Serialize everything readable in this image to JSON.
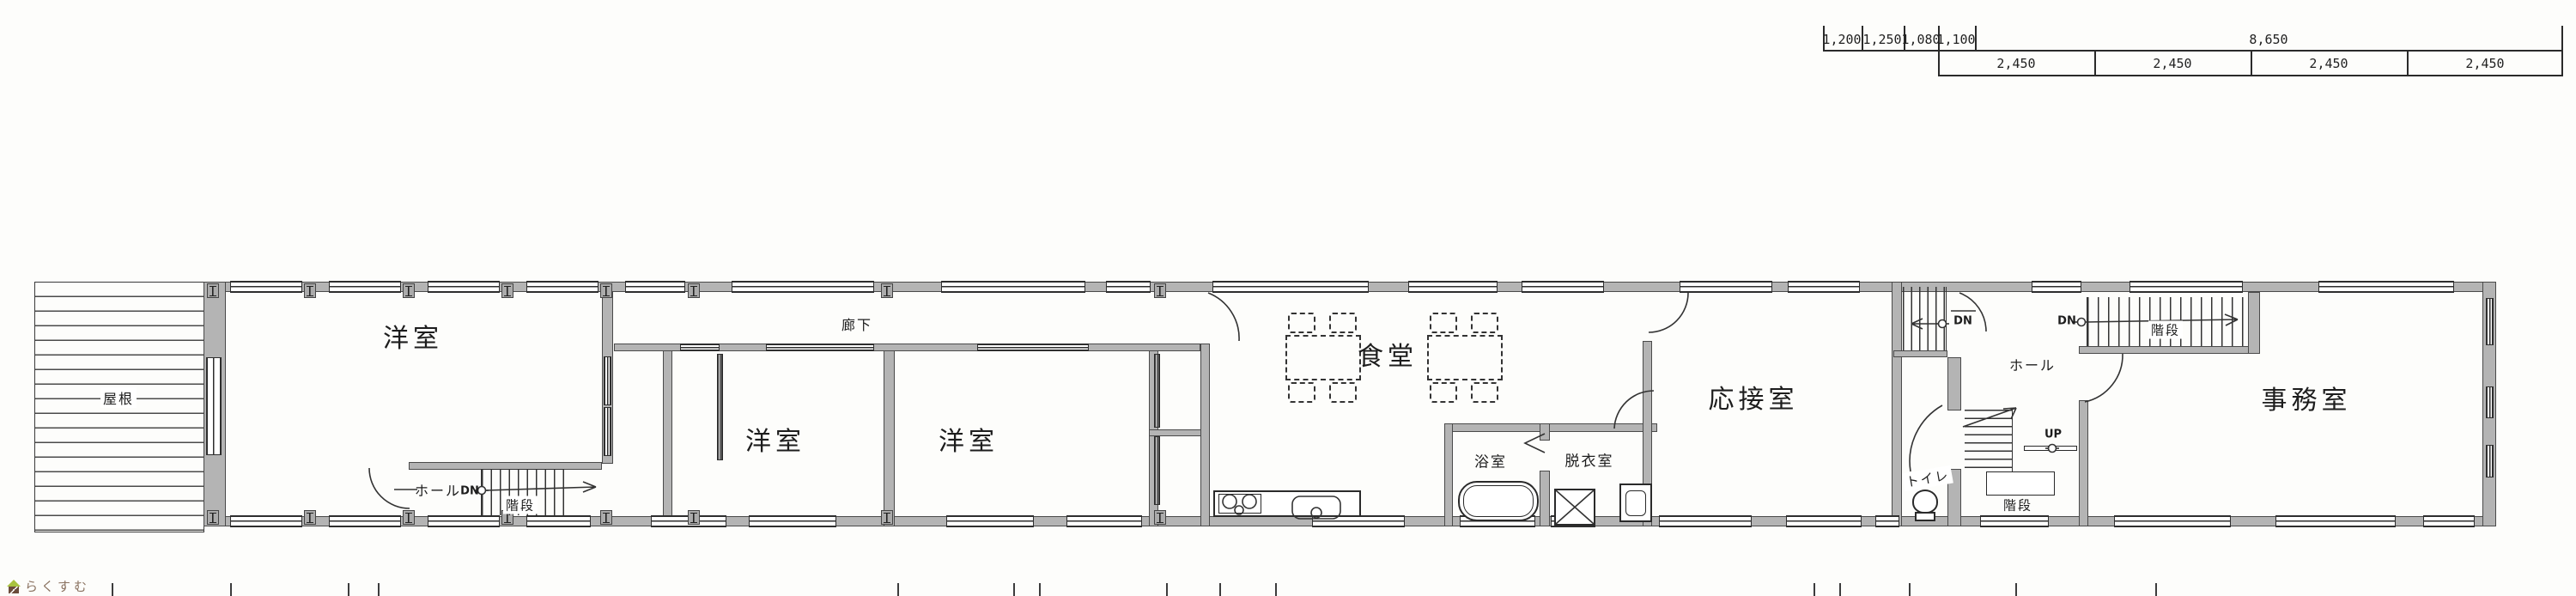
{
  "watermark": {
    "logo_text": "らくすむ"
  },
  "dimension_rows": {
    "row1": [
      "1,200",
      "1,250",
      "1,080",
      "1,100",
      "8,650"
    ],
    "row2": [
      "2,450",
      "2,450",
      "2,450",
      "2,450"
    ]
  },
  "labels": {
    "roof": "屋根",
    "western_room_1": "洋室",
    "western_room_2": "洋室",
    "western_room_3": "洋室",
    "corridor": "廊下",
    "dining_room": "食堂",
    "bathroom": "浴室",
    "dressing_room": "脱衣室",
    "reception_room": "応接室",
    "office": "事務室",
    "hall_west": "ホール",
    "hall_east": "ホール",
    "toilet": "トイレ",
    "stairs_west": "階段",
    "stairs_hall": "階段",
    "stairs_office": "階段",
    "down_west": "DN",
    "down_hall": "DN",
    "down_office": "DN",
    "up_hall": "UP"
  },
  "colors": {
    "wall_fill": "#b4b4b4",
    "line": "#2e2e2e",
    "logo_green": "#a9c23f",
    "logo_brown": "#6b4c3b",
    "logo_text_color": "#8a7260"
  }
}
